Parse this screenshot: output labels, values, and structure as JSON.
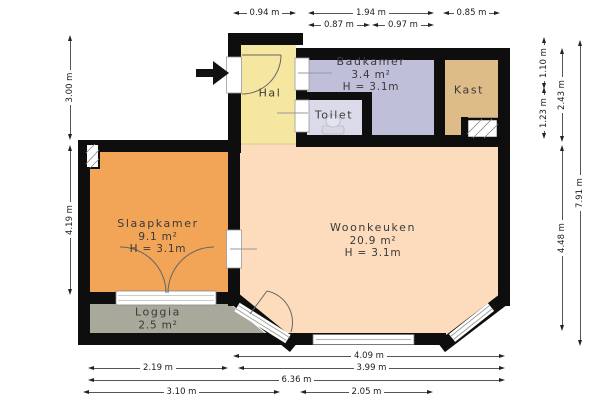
{
  "rooms": {
    "hal": {
      "name": "Hal"
    },
    "badkamer": {
      "name": "Badkamer",
      "area": "3.4 m²",
      "ceiling": "H = 3.1m"
    },
    "toilet": {
      "name": "Toilet"
    },
    "kast": {
      "name": "Kast"
    },
    "slaapkamer": {
      "name": "Slaapkamer",
      "area": "9.1 m²",
      "ceiling": "H = 3.1m"
    },
    "woonkeuken": {
      "name": "Woonkeuken",
      "area": "20.9 m²",
      "ceiling": "H = 3.1m"
    },
    "loggia": {
      "name": "Loggia",
      "area": "2.5 m²"
    }
  },
  "dimensions": {
    "top_row1": [
      "0.94 m",
      "1.94 m",
      "0.85 m"
    ],
    "top_row2": [
      "0.87 m",
      "0.97 m"
    ],
    "left": [
      "3.00 m",
      "4.19 m"
    ],
    "right_inner": [
      "1.10 m",
      "1.23 m"
    ],
    "right_middle": [
      "2.43 m",
      "4.48 m"
    ],
    "right_outer": [
      "7.91 m"
    ],
    "bottom_row1": [
      "4.09 m"
    ],
    "bottom_row2": [
      "2.19 m",
      "3.99 m"
    ],
    "bottom_row3": [
      "6.36 m"
    ],
    "bottom_row4": [
      "3.10 m",
      "2.05 m"
    ]
  },
  "colors": {
    "hal": "#f6e7a0",
    "badkamer": "#bfbfda",
    "toilet": "#dadae8",
    "kast": "#debc88",
    "slaapkamer": "#f2a457",
    "woonkeuken": "#fcdcbc",
    "loggia": "#a8a99b",
    "wall": "#0e0e0e"
  }
}
